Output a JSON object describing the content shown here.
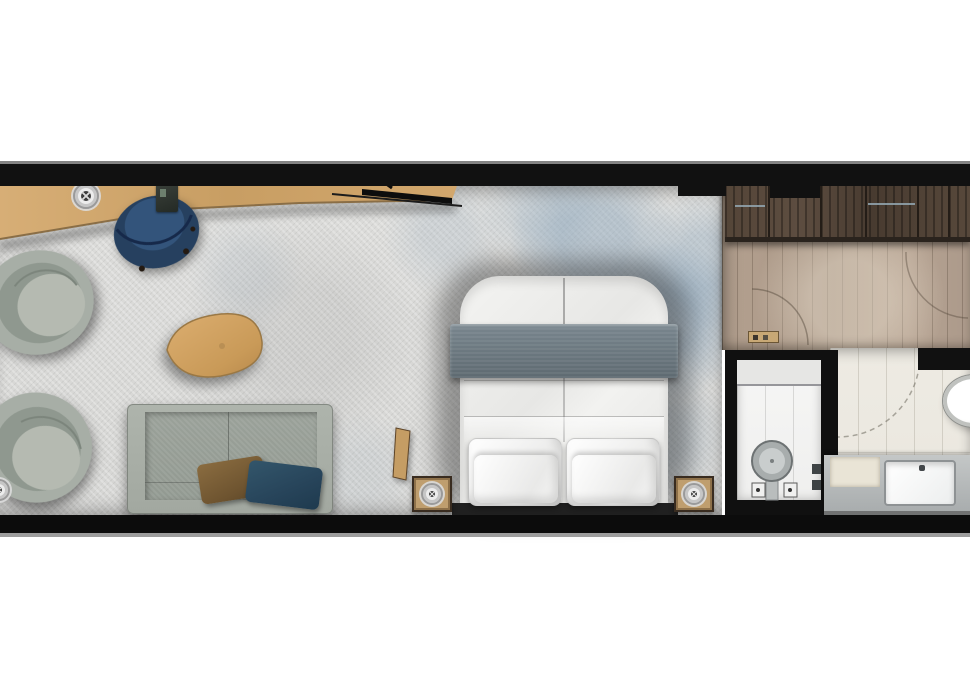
{
  "scene": {
    "type": "floor-plan",
    "label": "Hotel room floor plan, top-down render",
    "background_color": "#ffffff"
  },
  "colors": {
    "wall": "#111111",
    "carpet": "#d9d9d7",
    "carpet_accent_blue": "#8ca4ba",
    "desk_wood": "#cfa76e",
    "entry_wood_floor": "#ad9a89",
    "wardrobe_wood": "#51433a",
    "sofa_fabric": "#a6aca4",
    "armchair_fabric": "#a6ada5",
    "desk_chair_blue": "#2c4465",
    "bed_blanket_gray": "#6b7880",
    "bedding_white": "#f1f1f0",
    "pillow_brown": "#7d6138",
    "pillow_teal": "#2c4c60",
    "bath_tile": "#edeae2",
    "vanity_counter": "#b9bcbd",
    "fixture_white": "#ffffff"
  },
  "rooms": [
    {
      "id": "living-sleeping",
      "label": "Living and sleeping area",
      "floor": "patterned carpet"
    },
    {
      "id": "entry",
      "label": "Entry hall with wardrobe",
      "floor": "wood planks"
    },
    {
      "id": "wc",
      "label": "WC",
      "floor": "white tile"
    },
    {
      "id": "bathroom",
      "label": "Bathroom",
      "floor": "beige tile"
    }
  ],
  "furniture": {
    "desk": {
      "label": "Long wall desk"
    },
    "tv": {
      "label": "Wall-mounted TV"
    },
    "desk_chair": {
      "label": "Blue shell desk chair"
    },
    "armchair_top": {
      "label": "Swivel lounge chair"
    },
    "armchair_bottom": {
      "label": "Swivel lounge chair"
    },
    "coffee_table": {
      "label": "Pebble-shaped wooden coffee table"
    },
    "sofa": {
      "label": "Two-seat sofa with brown and teal cushions"
    },
    "bed": {
      "label": "Double bed with gray runner and four pillows"
    },
    "nightstand_left": {
      "label": "Nightstand"
    },
    "nightstand_right": {
      "label": "Nightstand"
    },
    "valet": {
      "label": "Leaning wooden valet"
    },
    "wardrobe": {
      "label": "Built-in wardrobe"
    },
    "toilet": {
      "label": "Toilet"
    },
    "oval_basin": {
      "label": "Freestanding oval basin"
    },
    "vanity": {
      "label": "Vanity counter with sink"
    }
  },
  "symbols": {
    "spotlight": {
      "label": "Ceiling spotlight symbol"
    },
    "door_arc": {
      "label": "Door swing arc"
    }
  }
}
